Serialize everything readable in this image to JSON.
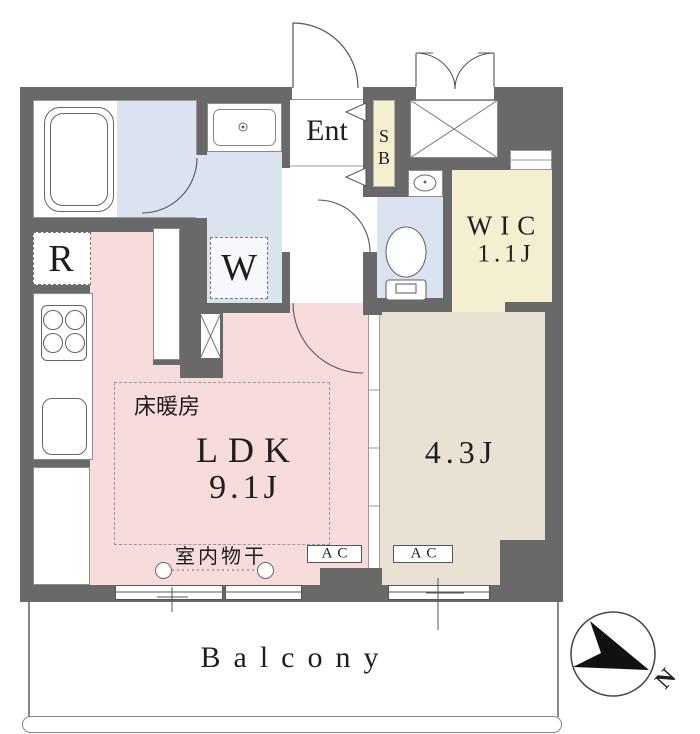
{
  "plan": {
    "type": "apartment-floorplan",
    "rooms": {
      "ldk": {
        "name": "LDK",
        "size": "9.1J",
        "floor_heating": "床暖房",
        "indoor_drying": "室内物干",
        "ac_label": "AC"
      },
      "bedroom": {
        "size": "4.3J",
        "ac_label": "AC"
      },
      "wic": {
        "name": "WIC",
        "size": "1.1J"
      },
      "entrance": {
        "label": "Ent"
      },
      "shoe_box": {
        "letter_top": "S",
        "letter_bottom": "B"
      },
      "kitchen": {
        "refrigerator_label": "R"
      },
      "washroom": {
        "washer_label": "W"
      },
      "balcony": {
        "label": "Balcony"
      }
    },
    "compass": {
      "north_label": "N"
    },
    "colors": {
      "wall": "#696969",
      "ldk_floor": "#f8dbdb",
      "wet_area_floor": "#dbe3f0",
      "storage_floor": "#f4efd1",
      "bedroom_floor": "#e9e2d4"
    }
  }
}
